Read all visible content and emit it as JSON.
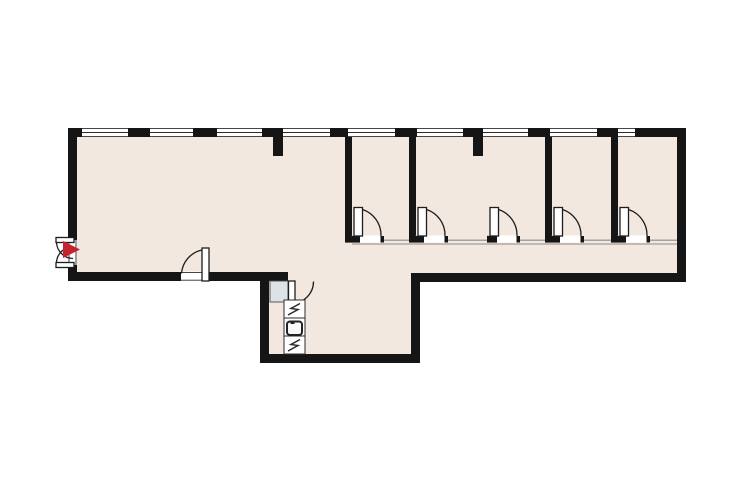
{
  "canvas": {
    "width": 740,
    "height": 493
  },
  "colors": {
    "background": "#ffffff",
    "floor": "#f2e8e0",
    "wall": "#151515",
    "window_frame": "#2b2b2b",
    "thin_partition": "#8a8a8a",
    "door_stroke": "#1d1d1d",
    "entrance_marker": "#c2252e",
    "shaft_fill": "#dde1e8",
    "shaft_stroke": "#4a4a4a",
    "fixture_stroke": "#2d2d2d"
  },
  "plan": {
    "type": "floor-plan",
    "window_count": 9,
    "interior_partition_count": 4,
    "room_door_count": 5,
    "entrance": {
      "style": "double-swing-door",
      "marker_icon": "red-arrow-right"
    },
    "exit_door": {
      "style": "single-swing-door"
    },
    "kitchen_unit": {
      "cells": [
        "appliance-zigzag-icon",
        "sink-icon",
        "appliance-zigzag-icon"
      ]
    },
    "shaft": {
      "style": "gray-box"
    }
  }
}
